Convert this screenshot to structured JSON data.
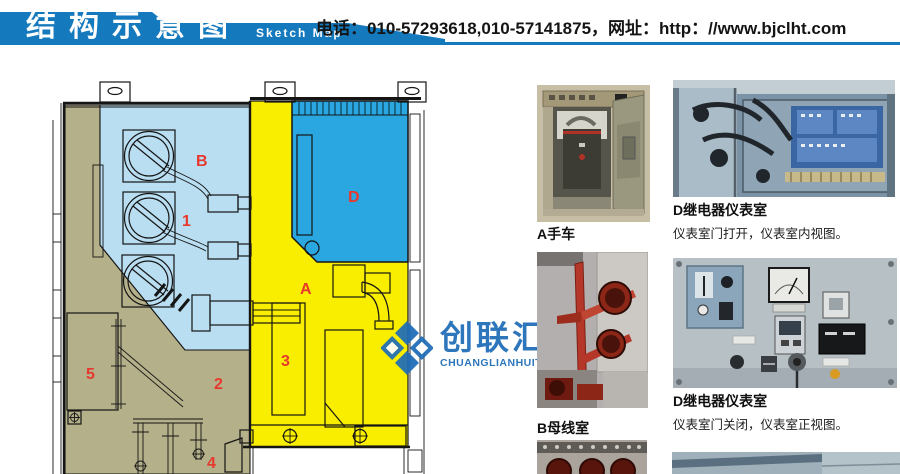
{
  "header": {
    "title_cn": "结构示意图",
    "title_en": "Sketch Map",
    "contact": "电话：010-57293618,010-57141875，网址：http：//www.bjclht.com",
    "accent_color": "#1579bd"
  },
  "watermark": {
    "name_cn": "创联汇通",
    "name_en": "CHUANGLIANHUITONG",
    "color": "#1e6cb8"
  },
  "diagram": {
    "region_labels": [
      {
        "text": "B",
        "x": 158,
        "y": 92
      },
      {
        "text": "1",
        "x": 144,
        "y": 152
      },
      {
        "text": "D",
        "x": 310,
        "y": 128
      },
      {
        "text": "A",
        "x": 262,
        "y": 220
      },
      {
        "text": "3",
        "x": 243,
        "y": 292
      },
      {
        "text": "2",
        "x": 176,
        "y": 315
      },
      {
        "text": "5",
        "x": 48,
        "y": 305
      },
      {
        "text": "4",
        "x": 169,
        "y": 394
      }
    ],
    "colors": {
      "busbar_room": "#b9ddf1",
      "instrument_room": "#2aa7e1",
      "breaker_room": "#f9ee00",
      "mechanism_area": "#b4b089",
      "label_red": "#e8382e"
    }
  },
  "photos": [
    {
      "caption": "A手车",
      "subcaption": ""
    },
    {
      "caption": "D继电器仪表室",
      "subcaption": "仪表室门打开，仪表室内视图。"
    },
    {
      "caption": "B母线室",
      "subcaption": ""
    },
    {
      "caption": "D继电器仪表室",
      "subcaption": "仪表室门关闭，仪表室正视图。"
    }
  ]
}
